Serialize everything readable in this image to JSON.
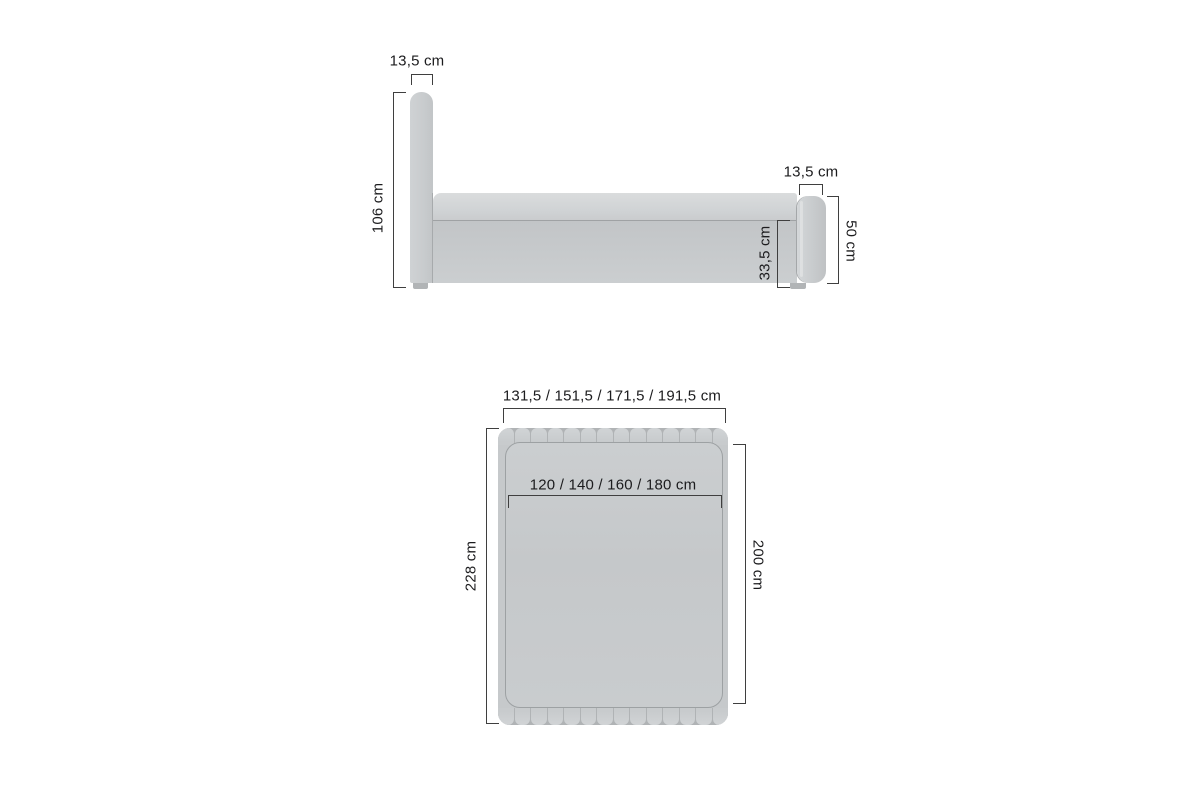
{
  "diagram": {
    "type": "furniture-dimension-drawing",
    "views": [
      "side-view",
      "top-view"
    ]
  },
  "side_view": {
    "headboard_width_label": "13,5 cm",
    "headboard_height_label": "106 cm",
    "footboard_width_label": "13,5 cm",
    "footboard_height_label": "50 cm",
    "frame_height_label": "33,5 cm"
  },
  "top_view": {
    "overall_width_label": "131,5 / 151,5 / 171,5 / 191,5 cm",
    "mattress_width_label": "120 / 140 / 160 / 180  cm",
    "overall_length_label": "228 cm",
    "mattress_length_label": "200 cm",
    "scallop_count": 14
  },
  "dimensions_cm": {
    "headboard_thickness": 13.5,
    "headboard_height": 106,
    "footboard_thickness": 13.5,
    "footboard_height": 50,
    "frame_height": 33.5,
    "overall_widths": [
      131.5,
      151.5,
      171.5,
      191.5
    ],
    "mattress_widths": [
      120,
      140,
      160,
      180
    ],
    "overall_length": 228,
    "mattress_length": 200
  },
  "colors": {
    "background": "#ffffff",
    "bed_fill": "#c8cbcd",
    "bed_fill_light": "#d6d9da",
    "bed_fill_dark": "#bfc2c4",
    "leg_fill": "#b1b4b6",
    "dimension_line": "#3f3f3f",
    "text": "#1c1c1e"
  }
}
